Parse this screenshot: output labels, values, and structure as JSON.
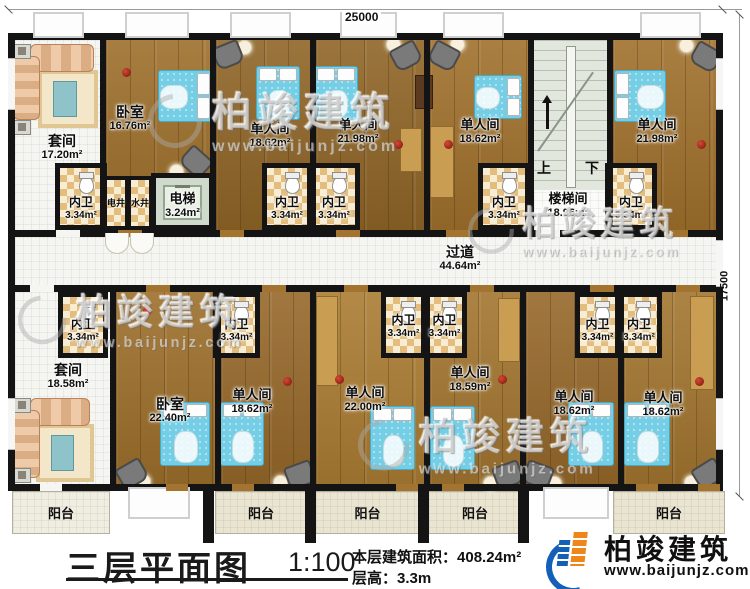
{
  "dimensions": {
    "top": "25000",
    "right": "17500"
  },
  "rooms": {
    "suite_top": {
      "name": "套间",
      "area": "17.20m²"
    },
    "bedroom_top": {
      "name": "卧室",
      "area": "16.76m²"
    },
    "single_t1": {
      "name": "单人间",
      "area": "18.62m²"
    },
    "single_t2": {
      "name": "单人间",
      "area": "21.98m²"
    },
    "single_t3": {
      "name": "单人间",
      "area": "18.62m²"
    },
    "single_t4": {
      "name": "单人间",
      "area": "21.98m²"
    },
    "stairwell": {
      "name": "楼梯间",
      "area": "18.96m²",
      "up": "上",
      "down": "下"
    },
    "elevator": {
      "name": "电梯",
      "area": "3.24m²"
    },
    "elec_shaft": {
      "name": "电井"
    },
    "water_shaft": {
      "name": "水井"
    },
    "corridor": {
      "name": "过道",
      "area": "44.64m²"
    },
    "suite_bottom": {
      "name": "套间",
      "area": "18.58m²"
    },
    "bedroom_bottom": {
      "name": "卧室",
      "area": "22.40m²"
    },
    "single_b1": {
      "name": "单人间",
      "area": "18.62m²"
    },
    "single_b2": {
      "name": "单人间",
      "area": "22.00m²"
    },
    "single_b3": {
      "name": "单人间",
      "area": "18.59m²"
    },
    "single_b4": {
      "name": "单人间",
      "area": "18.62m²"
    },
    "single_b5": {
      "name": "单人间",
      "area": "18.62m²"
    },
    "bathroom": {
      "name": "内卫",
      "area": "3.34m²"
    },
    "balcony": {
      "name": "阳台"
    }
  },
  "title": {
    "plan_name": "三层平面图",
    "scale": "1:100",
    "area_label": "本层建筑面积：",
    "area_value": "408.24m²",
    "height_label": "层高：",
    "height_value": "3.3m"
  },
  "brand": {
    "name": "柏竣建筑",
    "url": "www.baijunjz.com"
  },
  "watermark": {
    "name": "柏竣建筑",
    "url": "www.baijunjz.com"
  },
  "colors": {
    "wall": "#141414",
    "wood_floor": "#a2742f",
    "bathroom_tile": "#e3bd7e",
    "bed": "#74cee6",
    "brand_blue": "#1460b8",
    "brand_orange": "#f08519"
  }
}
